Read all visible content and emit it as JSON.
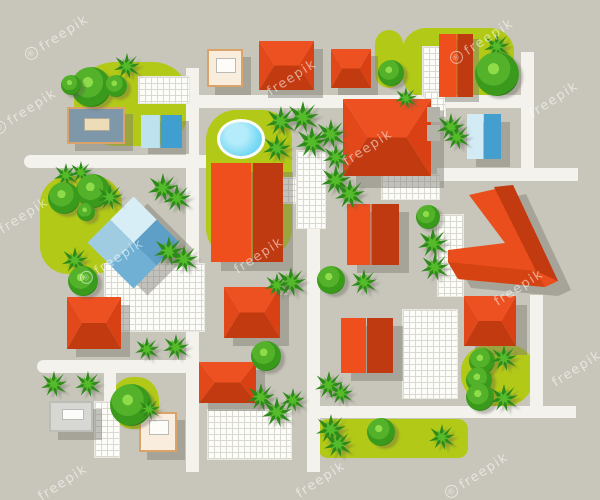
{
  "description": "Top view city neighborhood map illustration with houses, streets, trees and garden areas",
  "watermark_text": "freepik",
  "colors": {
    "background": "#c8c6bb",
    "road": "#f3f2ec",
    "green_area": "#b3c917",
    "grid_bg": "#fcfcf8",
    "grid_line": "#d9d9d1",
    "shadow": "rgba(125,123,112,0.45)",
    "watermark": "rgba(255,255,255,0.55)",
    "hip_faces": [
      "#ee5121",
      "#c23a0f",
      "#e2481a",
      "#d94114"
    ],
    "gable_variants": {
      "red": [
        "#ee4f1d",
        "#bf3a10"
      ],
      "blue": [
        "#bfe2ef",
        "#3f9fd1"
      ],
      "lblue": [
        "#d3ebf5",
        "#459fce"
      ]
    },
    "pyramid_faces": [
      "#5d9fc6",
      "#6fb0d4",
      "#9fcce0",
      "#d8eef6"
    ],
    "pond_fill": "#72d7f4",
    "pond_rim": "#fbfbf7",
    "bush_rings": [
      "#8edc4a",
      "#54b22a",
      "#3a9a1c",
      "#2c7c14"
    ],
    "palm_dark": "#2e8a1a",
    "palm_light": "#55bb2b",
    "cream_fill": "#f9eede",
    "cream_border": "#d9a36a",
    "cream_inner": "#fefcf8",
    "gray_fill": "#d7d7d4",
    "gray_border": "#bdbdb9",
    "gray_inner": "#fcfcfa",
    "bluegray_fill": "#7e97a9",
    "bluegray_border": "#d9a36a",
    "bluegray_inner": "#ecdcb8",
    "aux_gray": "#b4b3a9",
    "chevron_bright": "#e94e1c",
    "chevron_dark": "#c23a0f",
    "chevron_mid": "#d64312"
  },
  "scene": [
    {
      "k": "green",
      "n": "park-top-left",
      "x": 74,
      "y": 62,
      "w": 116,
      "h": 84,
      "br": "42px 38px 40px 44px"
    },
    {
      "k": "green",
      "n": "garden-center-with-pond",
      "x": 206,
      "y": 110,
      "w": 86,
      "h": 148,
      "br": "30px"
    },
    {
      "k": "green",
      "n": "park-top-right",
      "x": 402,
      "y": 28,
      "w": 112,
      "h": 70,
      "br": "24px"
    },
    {
      "k": "green",
      "n": "green-patch-top-mid",
      "x": 375,
      "y": 30,
      "w": 28,
      "h": 58,
      "br": "14px"
    },
    {
      "k": "green",
      "n": "park-mid-left",
      "x": 40,
      "y": 176,
      "w": 82,
      "h": 98,
      "br": "28px"
    },
    {
      "k": "green",
      "n": "green-patch-bottom-left",
      "x": 111,
      "y": 377,
      "w": 48,
      "h": 52,
      "br": "45%"
    },
    {
      "k": "green",
      "n": "green-strip-bottom",
      "x": 318,
      "y": 419,
      "w": 150,
      "h": 39,
      "br": "10px"
    },
    {
      "k": "green",
      "n": "green-patch-bottom-right",
      "x": 461,
      "y": 344,
      "w": 73,
      "h": 64,
      "br": "45% 40% 50% 55%"
    },
    {
      "k": "road",
      "n": "road-vertical-west",
      "x": 186,
      "y": 68,
      "w": 13,
      "h": 404
    },
    {
      "k": "road",
      "n": "road-horizontal-top",
      "x": 186,
      "y": 95,
      "w": 348,
      "h": 13
    },
    {
      "k": "road",
      "n": "road-vertical-northeast",
      "x": 521,
      "y": 52,
      "w": 13,
      "h": 129
    },
    {
      "k": "road",
      "n": "road-horizontal-upper-left",
      "x": 24,
      "y": 155,
      "w": 182,
      "h": 13,
      "r": "7px 0 0 7px"
    },
    {
      "k": "road",
      "n": "road-horizontal-east",
      "x": 437,
      "y": 168,
      "w": 141,
      "h": 13
    },
    {
      "k": "road",
      "n": "road-vertical-center",
      "x": 307,
      "y": 228,
      "w": 13,
      "h": 244
    },
    {
      "k": "road",
      "n": "road-horizontal-lower-left",
      "x": 37,
      "y": 360,
      "w": 160,
      "h": 13,
      "r": "7px 0 0 7px"
    },
    {
      "k": "road",
      "n": "road-vertical-small-left",
      "x": 104,
      "y": 373,
      "w": 12,
      "h": 32
    },
    {
      "k": "road",
      "n": "road-horizontal-bottom",
      "x": 313,
      "y": 406,
      "w": 263,
      "h": 12
    },
    {
      "k": "road",
      "n": "road-vertical-southeast",
      "x": 530,
      "y": 295,
      "w": 13,
      "h": 118
    },
    {
      "k": "grid",
      "n": "pavement-top-left",
      "x": 138,
      "y": 76,
      "w": 52,
      "h": 28
    },
    {
      "k": "grid",
      "n": "pavement-topright-1",
      "x": 422,
      "y": 46,
      "w": 18,
      "h": 51
    },
    {
      "k": "grid",
      "n": "pavement-topright-2",
      "x": 424,
      "y": 91,
      "w": 22,
      "h": 26
    },
    {
      "k": "grid",
      "n": "pavement-below-big-house",
      "x": 381,
      "y": 174,
      "w": 59,
      "h": 26
    },
    {
      "k": "grid",
      "n": "pavement-center-tall",
      "x": 296,
      "y": 150,
      "w": 30,
      "h": 79
    },
    {
      "k": "grid",
      "n": "pavement-center-small",
      "x": 281,
      "y": 177,
      "w": 16,
      "h": 27
    },
    {
      "k": "grid",
      "n": "plaza-mid-left",
      "x": 104,
      "y": 263,
      "w": 101,
      "h": 69
    },
    {
      "k": "grid",
      "n": "pavement-east",
      "x": 437,
      "y": 214,
      "w": 27,
      "h": 83
    },
    {
      "k": "grid",
      "n": "plaza-bottom-center",
      "x": 207,
      "y": 409,
      "w": 85,
      "h": 51
    },
    {
      "k": "grid",
      "n": "pavement-bottom-left",
      "x": 94,
      "y": 401,
      "w": 26,
      "h": 57
    },
    {
      "k": "grid",
      "n": "plaza-bottom-right",
      "x": 402,
      "y": 309,
      "w": 56,
      "h": 90
    },
    {
      "k": "pond",
      "n": "pond",
      "x": 217,
      "y": 119,
      "w": 48,
      "h": 40
    },
    {
      "k": "flat",
      "n": "bluegray-building",
      "x": 67,
      "y": 107,
      "w": 58,
      "h": 37,
      "v": "bluegray",
      "inner": [
        15,
        9,
        26,
        13
      ],
      "sh": [
        8,
        7
      ]
    },
    {
      "k": "gable",
      "n": "blue-box-building",
      "x": 141,
      "y": 115,
      "w": 41,
      "h": 33,
      "v": "blue",
      "sp": 46,
      "sh": [
        7,
        6
      ]
    },
    {
      "k": "flat",
      "n": "cream-building-top",
      "x": 207,
      "y": 49,
      "w": 36,
      "h": 38,
      "v": "cream",
      "inner": [
        7,
        7,
        20,
        15
      ],
      "sh": [
        8,
        8
      ]
    },
    {
      "k": "hip",
      "n": "red-house-top-1",
      "x": 259,
      "y": 41,
      "w": 55,
      "h": 49,
      "sh": [
        9,
        8
      ]
    },
    {
      "k": "hip",
      "n": "red-house-top-2",
      "x": 331,
      "y": 49,
      "w": 40,
      "h": 39,
      "sh": [
        7,
        7
      ]
    },
    {
      "k": "gable",
      "n": "red-gable-topright",
      "x": 439,
      "y": 34,
      "w": 34,
      "h": 63,
      "v": "red",
      "sp": 52,
      "sh": [
        6,
        5
      ]
    },
    {
      "k": "hip",
      "n": "red-house-large",
      "x": 343,
      "y": 99,
      "w": 88,
      "h": 77,
      "sh": [
        13,
        12
      ]
    },
    {
      "k": "gable",
      "n": "red-building-tall-center",
      "x": 211,
      "y": 163,
      "w": 72,
      "h": 99,
      "v": "red",
      "sp": 56,
      "sh": [
        10,
        9
      ]
    },
    {
      "k": "gable",
      "n": "red-house-mid-east",
      "x": 347,
      "y": 204,
      "w": 52,
      "h": 61,
      "v": "red",
      "sp": 45,
      "sh": [
        10,
        8
      ]
    },
    {
      "k": "flat",
      "n": "gray-block-1",
      "x": 427,
      "y": 107,
      "w": 13,
      "h": 15,
      "v": "aux"
    },
    {
      "k": "flat",
      "n": "gray-block-2",
      "x": 427,
      "y": 125,
      "w": 13,
      "h": 16,
      "v": "aux"
    },
    {
      "k": "gable",
      "n": "blue-gable-building",
      "x": 467,
      "y": 114,
      "w": 34,
      "h": 45,
      "v": "lblue",
      "sp": 48,
      "sh": [
        9,
        8
      ]
    },
    {
      "k": "pyramid",
      "n": "blue-pyramid-building",
      "x": 101,
      "y": 210,
      "s": 65,
      "sh": [
        14,
        7
      ]
    },
    {
      "k": "svg",
      "n": "chevron-building",
      "x": 440,
      "y": 178,
      "w": 150,
      "h": 135,
      "polys": [
        {
          "pts": "42,26 86,16 131,112 118,118 31,110 21,93 21,81 78,74",
          "f": "shadow"
        },
        {
          "pts": "29,17 73,7 118,103 105,109 18,101 8,84 8,72 65,65",
          "f": "#e94e1c"
        },
        {
          "pts": "54,9 73,7 118,103 96,93",
          "f": "#c23a0f"
        },
        {
          "pts": "8,84 96,93 105,109 18,101",
          "f": "#d64312"
        }
      ]
    },
    {
      "k": "hip",
      "n": "red-house-bottom-right",
      "x": 464,
      "y": 296,
      "w": 52,
      "h": 50,
      "sh": [
        11,
        9
      ]
    },
    {
      "k": "gable",
      "n": "red-gable-bottom-center",
      "x": 341,
      "y": 318,
      "w": 52,
      "h": 55,
      "v": "red",
      "sp": 48,
      "sh": [
        10,
        8
      ]
    },
    {
      "k": "hip",
      "n": "red-house-center-south",
      "x": 224,
      "y": 287,
      "w": 56,
      "h": 51,
      "sh": [
        9,
        8
      ]
    },
    {
      "k": "hip",
      "n": "red-house-left-south",
      "x": 67,
      "y": 297,
      "w": 54,
      "h": 52,
      "sh": [
        9,
        8
      ]
    },
    {
      "k": "hip",
      "n": "red-house-bottom-mid",
      "x": 199,
      "y": 362,
      "w": 57,
      "h": 41,
      "sh": [
        9,
        8
      ]
    },
    {
      "k": "flat",
      "n": "gray-building-bottom-left",
      "x": 49,
      "y": 401,
      "w": 44,
      "h": 31,
      "v": "gray",
      "inner": [
        11,
        6,
        22,
        11
      ],
      "sh": [
        9,
        8
      ]
    },
    {
      "k": "flat",
      "n": "cream-building-bottom",
      "x": 139,
      "y": 412,
      "w": 38,
      "h": 40,
      "v": "cream",
      "inner": [
        8,
        6,
        20,
        15
      ],
      "sh": [
        8,
        8
      ]
    },
    {
      "k": "palm",
      "n": "tree-palm",
      "x": 114,
      "y": 53,
      "d": 26
    },
    {
      "k": "bush",
      "n": "tree-bush",
      "x": 71,
      "y": 67,
      "d": 40
    },
    {
      "k": "bush",
      "n": "tree-bush",
      "x": 105,
      "y": 75,
      "d": 22
    },
    {
      "k": "bush",
      "n": "tree-bush",
      "x": 61,
      "y": 75,
      "d": 20
    },
    {
      "k": "palm",
      "n": "tree-palm",
      "x": 484,
      "y": 33,
      "d": 26
    },
    {
      "k": "bush",
      "n": "tree-bush",
      "x": 475,
      "y": 52,
      "d": 44
    },
    {
      "k": "bush",
      "n": "tree-bush",
      "x": 378,
      "y": 60,
      "d": 26
    },
    {
      "k": "palm",
      "n": "tree-palm",
      "x": 54,
      "y": 163,
      "d": 24
    },
    {
      "k": "palm",
      "n": "tree-palm",
      "x": 70,
      "y": 161,
      "d": 22
    },
    {
      "k": "bush",
      "n": "tree-bush",
      "x": 48,
      "y": 182,
      "d": 32
    },
    {
      "k": "bush",
      "n": "tree-bush",
      "x": 76,
      "y": 174,
      "d": 34
    },
    {
      "k": "palm",
      "n": "tree-palm",
      "x": 97,
      "y": 184,
      "d": 26
    },
    {
      "k": "bush",
      "n": "tree-bush",
      "x": 77,
      "y": 203,
      "d": 18
    },
    {
      "k": "palm",
      "n": "tree-palm",
      "x": 62,
      "y": 247,
      "d": 26
    },
    {
      "k": "bush",
      "n": "tree-bush",
      "x": 68,
      "y": 266,
      "d": 30
    },
    {
      "k": "palm",
      "n": "tree-palm",
      "x": 148,
      "y": 173,
      "d": 30
    },
    {
      "k": "palm",
      "n": "tree-palm",
      "x": 163,
      "y": 184,
      "d": 28
    },
    {
      "k": "palm",
      "n": "tree-palm",
      "x": 154,
      "y": 236,
      "d": 30
    },
    {
      "k": "palm",
      "n": "tree-palm",
      "x": 170,
      "y": 245,
      "d": 28
    },
    {
      "k": "palm",
      "n": "tree-palm",
      "x": 266,
      "y": 106,
      "d": 30
    },
    {
      "k": "palm",
      "n": "tree-palm",
      "x": 287,
      "y": 101,
      "d": 32
    },
    {
      "k": "palm",
      "n": "tree-palm",
      "x": 296,
      "y": 126,
      "d": 32
    },
    {
      "k": "palm",
      "n": "tree-palm",
      "x": 316,
      "y": 119,
      "d": 30
    },
    {
      "k": "palm",
      "n": "tree-palm",
      "x": 263,
      "y": 134,
      "d": 28
    },
    {
      "k": "palm",
      "n": "tree-palm",
      "x": 323,
      "y": 144,
      "d": 26
    },
    {
      "k": "palm",
      "n": "tree-palm",
      "x": 321,
      "y": 165,
      "d": 30
    },
    {
      "k": "palm",
      "n": "tree-palm",
      "x": 335,
      "y": 179,
      "d": 30
    },
    {
      "k": "palm",
      "n": "tree-palm",
      "x": 395,
      "y": 87,
      "d": 22
    },
    {
      "k": "palm",
      "n": "tree-palm",
      "x": 437,
      "y": 113,
      "d": 28
    },
    {
      "k": "palm",
      "n": "tree-palm",
      "x": 444,
      "y": 124,
      "d": 26
    },
    {
      "k": "bush",
      "n": "tree-bush",
      "x": 416,
      "y": 205,
      "d": 24
    },
    {
      "k": "palm",
      "n": "tree-palm",
      "x": 418,
      "y": 228,
      "d": 30
    },
    {
      "k": "palm",
      "n": "tree-palm",
      "x": 421,
      "y": 253,
      "d": 28
    },
    {
      "k": "palm",
      "n": "tree-palm",
      "x": 276,
      "y": 267,
      "d": 30
    },
    {
      "k": "palm",
      "n": "tree-palm",
      "x": 265,
      "y": 273,
      "d": 24
    },
    {
      "k": "bush",
      "n": "tree-bush",
      "x": 317,
      "y": 266,
      "d": 28
    },
    {
      "k": "palm",
      "n": "tree-palm",
      "x": 351,
      "y": 269,
      "d": 26
    },
    {
      "k": "bush",
      "n": "tree-bush",
      "x": 251,
      "y": 341,
      "d": 30
    },
    {
      "k": "palm",
      "n": "tree-palm",
      "x": 247,
      "y": 383,
      "d": 28
    },
    {
      "k": "palm",
      "n": "tree-palm",
      "x": 262,
      "y": 397,
      "d": 30
    },
    {
      "k": "palm",
      "n": "tree-palm",
      "x": 281,
      "y": 388,
      "d": 24
    },
    {
      "k": "palm",
      "n": "tree-palm",
      "x": 135,
      "y": 337,
      "d": 24
    },
    {
      "k": "palm",
      "n": "tree-palm",
      "x": 163,
      "y": 334,
      "d": 26
    },
    {
      "k": "palm",
      "n": "tree-palm",
      "x": 41,
      "y": 371,
      "d": 26
    },
    {
      "k": "palm",
      "n": "tree-palm",
      "x": 75,
      "y": 371,
      "d": 26
    },
    {
      "k": "bush",
      "n": "tree-bush",
      "x": 110,
      "y": 384,
      "d": 42
    },
    {
      "k": "palm",
      "n": "tree-palm",
      "x": 138,
      "y": 398,
      "d": 22
    },
    {
      "k": "palm",
      "n": "tree-palm",
      "x": 315,
      "y": 371,
      "d": 28
    },
    {
      "k": "palm",
      "n": "tree-palm",
      "x": 329,
      "y": 381,
      "d": 24
    },
    {
      "k": "palm",
      "n": "tree-palm",
      "x": 316,
      "y": 414,
      "d": 30
    },
    {
      "k": "palm",
      "n": "tree-palm",
      "x": 324,
      "y": 430,
      "d": 28
    },
    {
      "k": "bush",
      "n": "tree-bush",
      "x": 367,
      "y": 418,
      "d": 28
    },
    {
      "k": "palm",
      "n": "tree-palm",
      "x": 429,
      "y": 424,
      "d": 26
    },
    {
      "k": "bush",
      "n": "tree-bush",
      "x": 469,
      "y": 348,
      "d": 26
    },
    {
      "k": "palm",
      "n": "tree-palm",
      "x": 491,
      "y": 345,
      "d": 26
    },
    {
      "k": "bush",
      "n": "tree-bush",
      "x": 466,
      "y": 367,
      "d": 26
    },
    {
      "k": "bush",
      "n": "tree-bush",
      "x": 466,
      "y": 383,
      "d": 28
    },
    {
      "k": "palm",
      "n": "tree-palm",
      "x": 490,
      "y": 384,
      "d": 28
    },
    {
      "k": "wm",
      "cx": 57,
      "cy": 38,
      "pre": true
    },
    {
      "k": "wm",
      "cx": 292,
      "cy": 78,
      "pre": false
    },
    {
      "k": "wm",
      "cx": 482,
      "cy": 42,
      "pre": true
    },
    {
      "k": "wm",
      "cx": 25,
      "cy": 112,
      "pre": true
    },
    {
      "k": "wm",
      "cx": 368,
      "cy": 148,
      "pre": false
    },
    {
      "k": "wm",
      "cx": 554,
      "cy": 100,
      "pre": false
    },
    {
      "k": "wm",
      "cx": 259,
      "cy": 256,
      "pre": false
    },
    {
      "k": "wm",
      "cx": 519,
      "cy": 288,
      "pre": false
    },
    {
      "k": "wm",
      "cx": 24,
      "cy": 216,
      "pre": false
    },
    {
      "k": "wm",
      "cx": 112,
      "cy": 262,
      "pre": true
    },
    {
      "k": "wm",
      "cx": 577,
      "cy": 369,
      "pre": false
    },
    {
      "k": "wm",
      "cx": 321,
      "cy": 480,
      "pre": false
    },
    {
      "k": "wm",
      "cx": 477,
      "cy": 476,
      "pre": true
    },
    {
      "k": "wm",
      "cx": 63,
      "cy": 483,
      "pre": false
    }
  ]
}
